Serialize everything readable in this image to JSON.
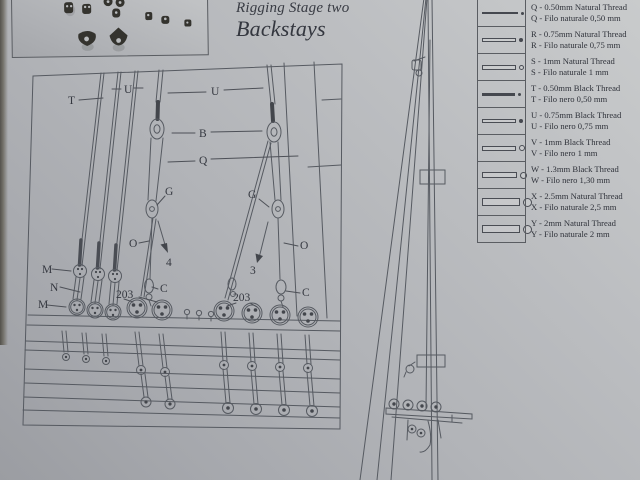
{
  "page": {
    "title1": "Rigging Stage two",
    "title2": "Backstays"
  },
  "diagram": {
    "labels": {
      "t": "T",
      "u1": "U",
      "u2": "U",
      "b": "B",
      "q": "Q",
      "g1": "G",
      "g2": "G",
      "o1": "O",
      "o2": "O",
      "n4": "4",
      "n3": "3",
      "m1": "M",
      "n": "N",
      "m2": "M",
      "p203l": "203",
      "cl": "C",
      "p203r": "203",
      "cr": "C"
    }
  },
  "legend": {
    "rows": [
      {
        "code": "Q",
        "line1": "Q - 0.50mm Natural Thread",
        "line2": "Q - Filo naturale 0,50 mm",
        "bar": {
          "w": 36,
          "h": 2,
          "style": "solid"
        },
        "dot": {
          "d": 3,
          "style": "solid"
        }
      },
      {
        "code": "R",
        "line1": "R - 0.75mm Natural Thread",
        "line2": "R - Filo naturale 0,75 mm",
        "bar": {
          "w": 34,
          "h": 4,
          "style": "outline"
        },
        "dot": {
          "d": 4,
          "style": "solid"
        }
      },
      {
        "code": "S",
        "line1": "S - 1mm Natural Thread",
        "line2": "S - Filo naturale 1 mm",
        "bar": {
          "w": 34,
          "h": 5,
          "style": "outline"
        },
        "dot": {
          "d": 5,
          "style": "outline"
        }
      },
      {
        "code": "T",
        "line1": "T - 0.50mm Black Thread",
        "line2": "T - Filo nero 0,50 mm",
        "bar": {
          "w": 33,
          "h": 3,
          "style": "solid"
        },
        "dot": {
          "d": 3,
          "style": "solid"
        }
      },
      {
        "code": "U",
        "line1": "U - 0.75mm Black Thread",
        "line2": "U - Filo nero 0,75 mm",
        "bar": {
          "w": 34,
          "h": 4,
          "style": "outline"
        },
        "dot": {
          "d": 4,
          "style": "solid"
        }
      },
      {
        "code": "V",
        "line1": "V - 1mm Black Thread",
        "line2": "V - Filo nero 1 mm",
        "bar": {
          "w": 34,
          "h": 5,
          "style": "outline"
        },
        "dot": {
          "d": 6,
          "style": "outline"
        }
      },
      {
        "code": "W",
        "line1": "W - 1.3mm Black Thread",
        "line2": "W - Filo nero 1,30 mm",
        "bar": {
          "w": 35,
          "h": 6,
          "style": "outline"
        },
        "dot": {
          "d": 7,
          "style": "outline"
        }
      },
      {
        "code": "X",
        "line1": "X - 2.5mm Natural Thread",
        "line2": "X - Filo naturale 2,5 mm",
        "bar": {
          "w": 38,
          "h": 8,
          "style": "outline"
        },
        "dot": {
          "d": 9,
          "style": "outline"
        }
      },
      {
        "code": "Y",
        "line1": "Y - 2mm Natural Thread",
        "line2": "Y - Filo naturale 2 mm",
        "bar": {
          "w": 38,
          "h": 8,
          "style": "outline"
        },
        "dot": {
          "d": 9,
          "style": "outline"
        }
      }
    ]
  },
  "colors": {
    "paper": "#b2b4b8",
    "line": "#565a61",
    "text": "#353840",
    "dark_part": "#34332e"
  }
}
